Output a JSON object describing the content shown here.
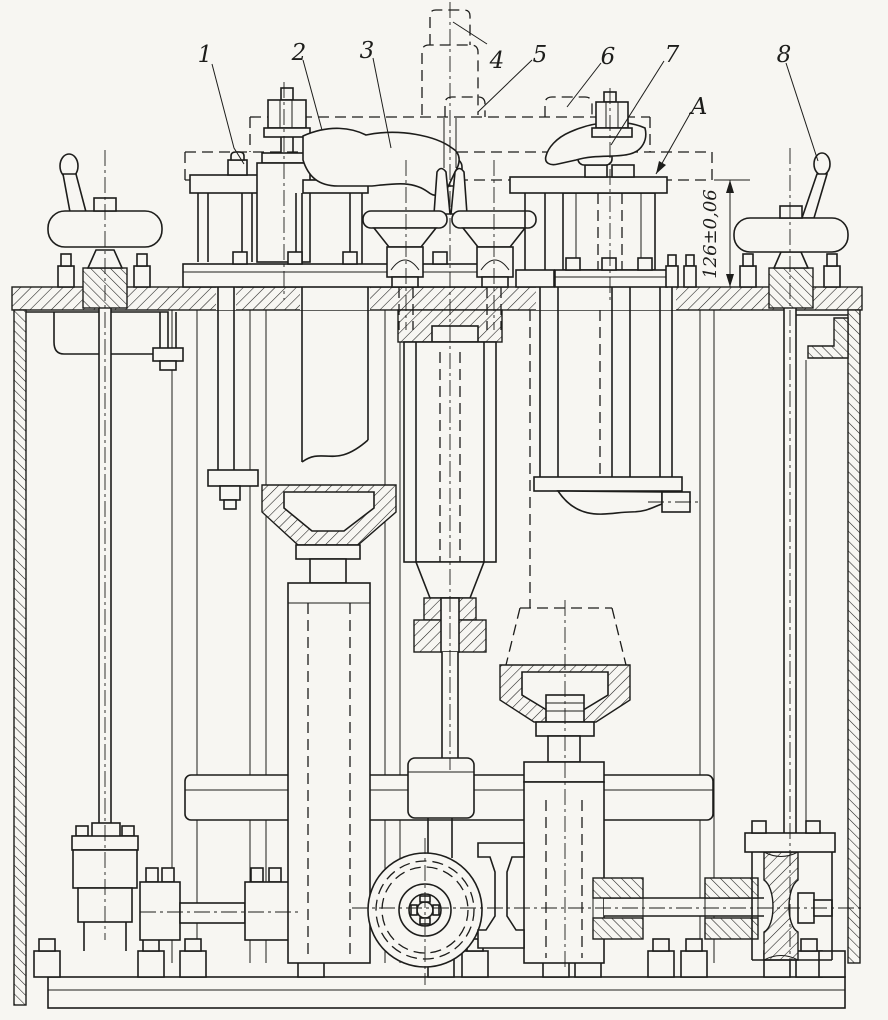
{
  "callouts": [
    {
      "label": "1"
    },
    {
      "label": "2"
    },
    {
      "label": "3"
    },
    {
      "label": "4"
    },
    {
      "label": "5"
    },
    {
      "label": "6"
    },
    {
      "label": "7"
    },
    {
      "label": "8"
    }
  ],
  "view_label": "A",
  "dimension": {
    "text": "126±0,06"
  },
  "colors": {
    "paper": "#f7f6f2",
    "ink": "#1d1d1b"
  }
}
